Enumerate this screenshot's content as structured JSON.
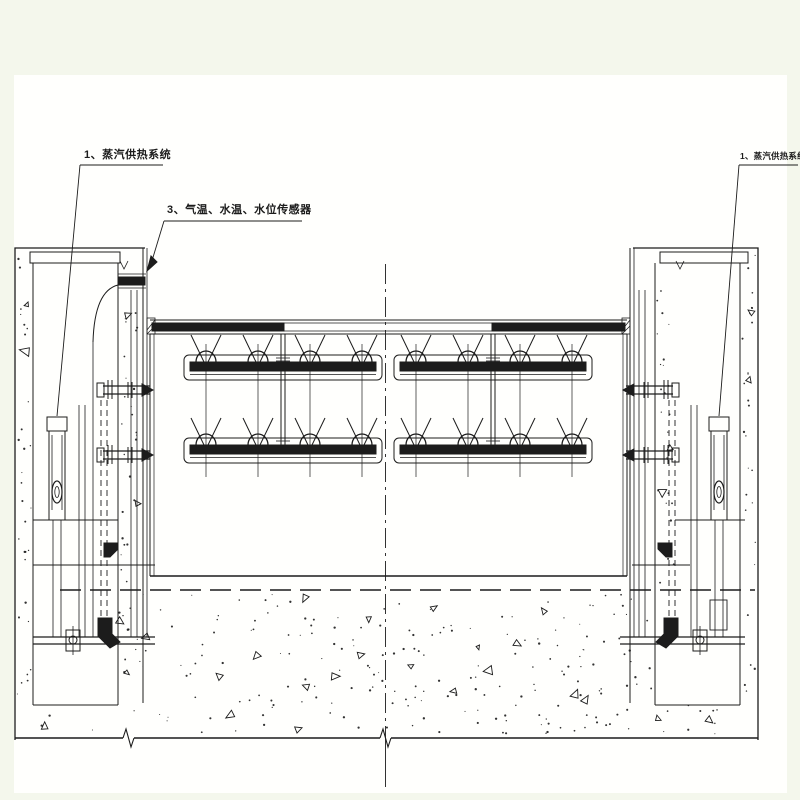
{
  "drawing": {
    "labels": {
      "left_system": "1、蒸汽供热系统",
      "sensors": "3、气温、水温、水位传感器",
      "right_system": "1、蒸汽供热系统"
    },
    "colors": {
      "ink": "#1c1c1c",
      "paper": "#fffffd",
      "margin": "#f4f7ec"
    }
  }
}
